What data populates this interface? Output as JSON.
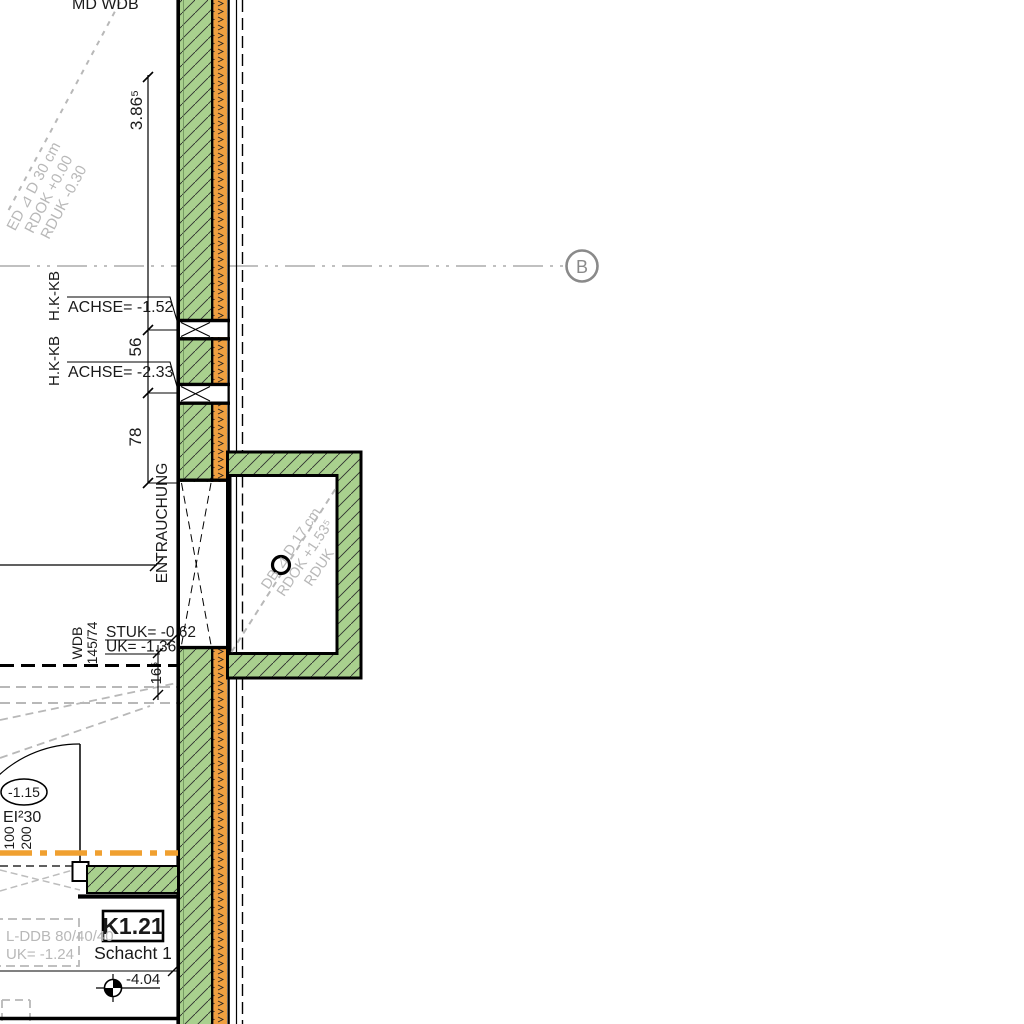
{
  "drawing": {
    "type": "architectural-plan-section",
    "grid_axis": {
      "label": "B"
    },
    "dimensions": {
      "d_386": "3.86⁵",
      "d_56": "56",
      "d_78": "78",
      "d_165": "16⁵"
    },
    "annotations": {
      "top_wall_label": "MD WDB",
      "slab_note_top": {
        "line1": "ED ⊿ D 30 cm",
        "line2": "RDOK +0.00",
        "line3": "RDUK -0.30"
      },
      "hk1": {
        "tag": "H.K-KB",
        "text": "ACHSE= -1.52"
      },
      "hk2": {
        "tag": "H.K-KB",
        "text": "ACHSE= -2.33"
      },
      "entrauchung": "ENTRAUCHUNG",
      "wdb": {
        "tag": "WDB",
        "size": "145/74",
        "stuk": "STUK= -0.62",
        "uk": "UK= -1.36"
      },
      "slab_note_box": {
        "line1": "DB ⊿ D 17 cm",
        "line2": "RDOK +1.53⁵",
        "line3": "RDUK"
      },
      "door": {
        "level": "-1.15",
        "fire_rating": "EI²30",
        "width": "100",
        "height": "200"
      },
      "room": {
        "number": "K1.21",
        "name": "Schacht 1"
      },
      "lddb": {
        "line1": "L-DDB 80/40/40",
        "line2": "UK= -1.24"
      },
      "level_bottom": "-4.04"
    },
    "colors": {
      "wall_green": "#a9d08e",
      "insulation_orange": "#f0a040",
      "fire_line_orange": "#f0a030",
      "annotation_gray": "#b8b8b8",
      "axis_gray": "#8a8a8a"
    }
  }
}
